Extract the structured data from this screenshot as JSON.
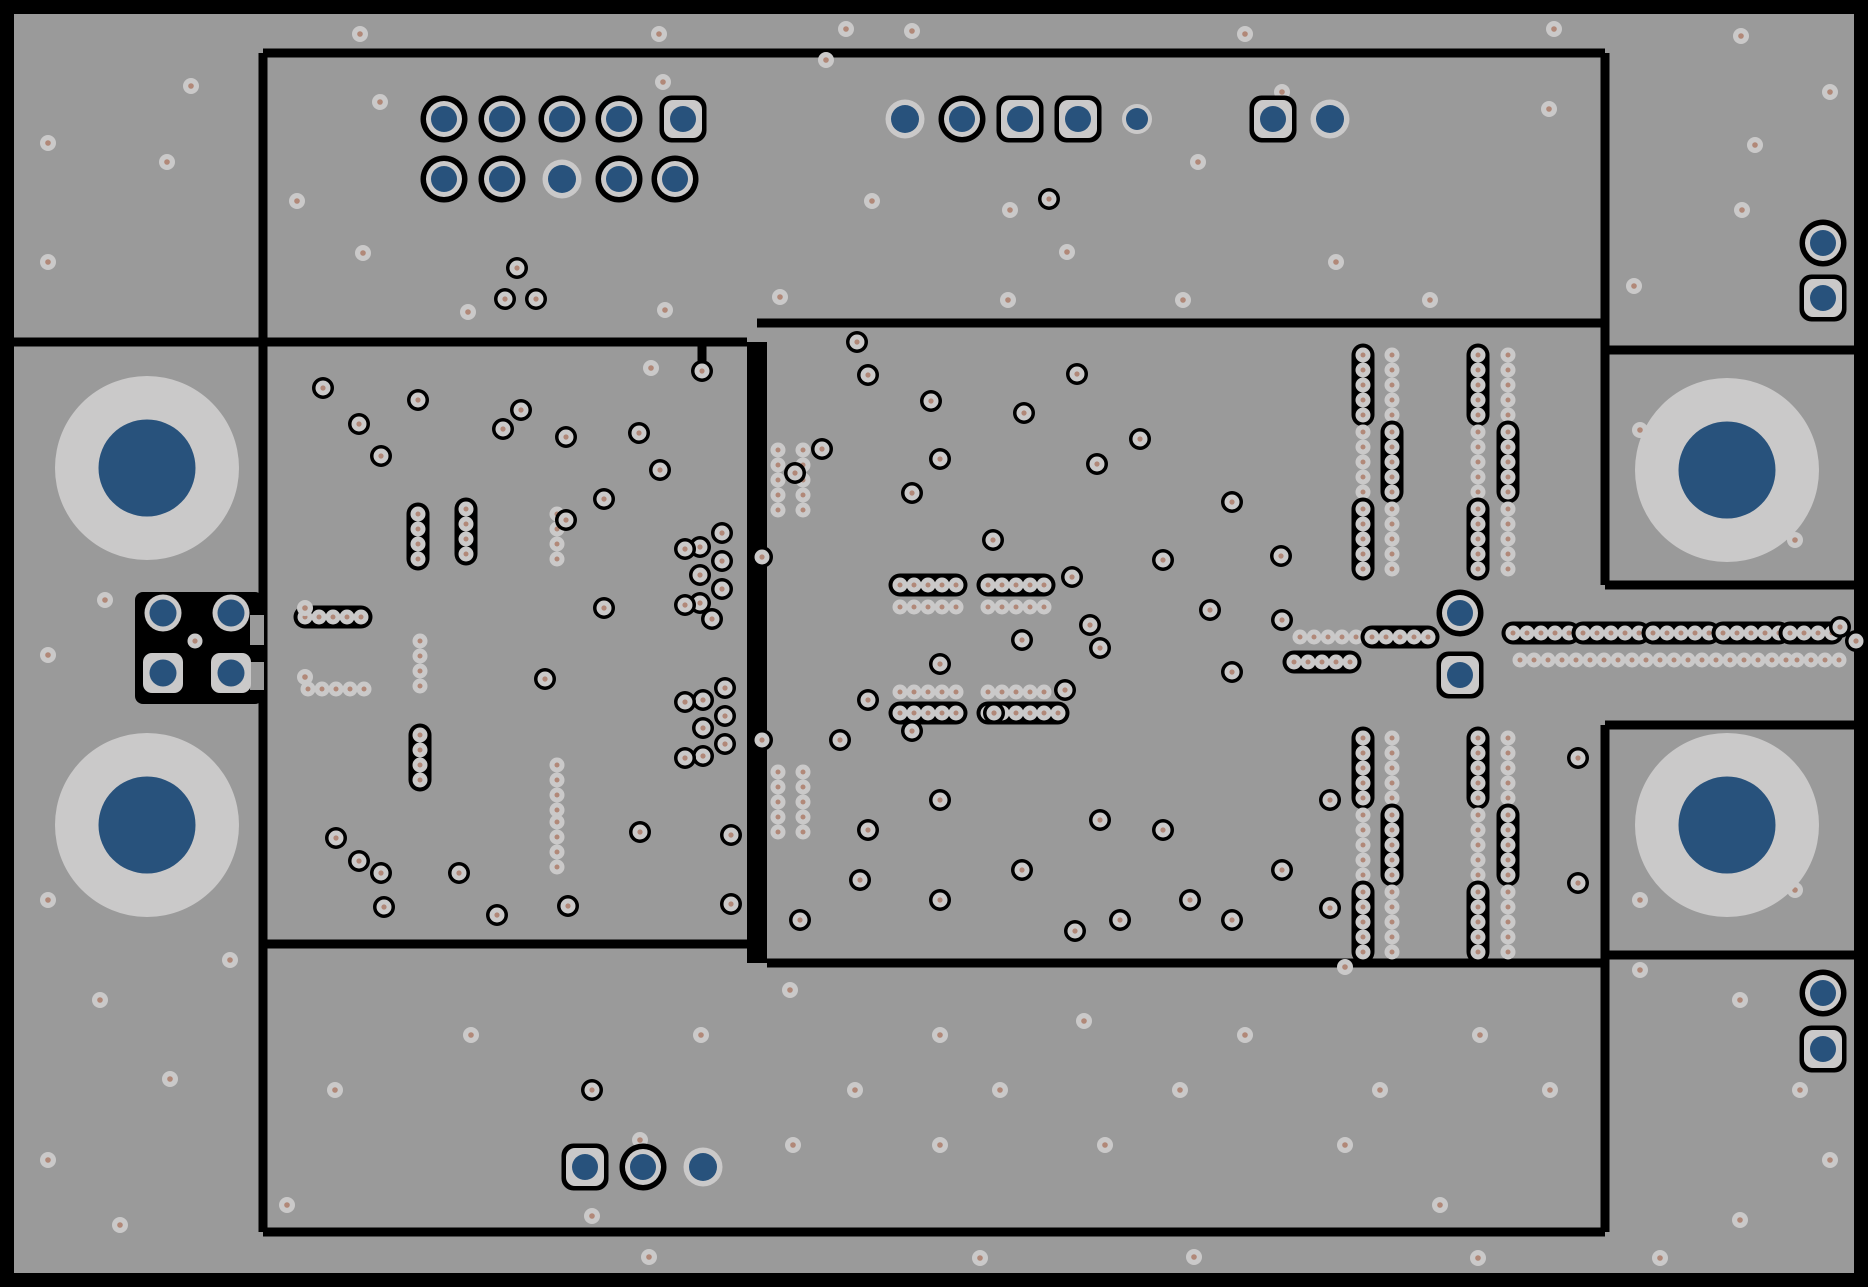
{
  "canvas": {
    "width": 1868,
    "height": 1287
  },
  "colors": {
    "background": "#000000",
    "copper": "#9a9a9a",
    "annular": "#cac9c9",
    "navy": "#28527c",
    "drill": "#b18878",
    "line": "#000000"
  },
  "board": {
    "frame": {
      "x": 14,
      "y": 14,
      "w": 1840,
      "h": 1259
    },
    "lines": [
      [
        263,
        53,
        1605,
        53
      ],
      [
        263,
        53,
        263,
        1232
      ],
      [
        1605,
        53,
        1605,
        585
      ],
      [
        14,
        342,
        747,
        342
      ],
      [
        757,
        323,
        1605,
        323
      ],
      [
        1605,
        350,
        1854,
        350
      ],
      [
        263,
        944,
        757,
        944
      ],
      [
        767,
        963,
        1605,
        963
      ],
      [
        1605,
        585,
        1854,
        585
      ],
      [
        1605,
        725,
        1854,
        725
      ],
      [
        1605,
        725,
        1605,
        1232
      ],
      [
        1605,
        955,
        1854,
        955
      ],
      [
        263,
        1232,
        1605,
        1232
      ],
      [
        702,
        342,
        702,
        364
      ]
    ],
    "divider": {
      "x": 747,
      "y": 342,
      "w": 20,
      "h": 621
    },
    "pad_cutout": {
      "x": 135,
      "y": 592,
      "w": 128,
      "h": 112,
      "r": 8,
      "notches": [
        [
          250,
          615,
          14,
          30
        ],
        [
          250,
          662,
          14,
          28
        ]
      ]
    }
  },
  "mount_holes": [
    [
      147,
      468
    ],
    [
      147,
      825
    ],
    [
      1727,
      470
    ],
    [
      1727,
      825
    ]
  ],
  "pads": {
    "ring": [
      [
        444,
        119
      ],
      [
        502,
        119
      ],
      [
        562,
        119
      ],
      [
        619,
        119
      ],
      [
        444,
        179
      ],
      [
        502,
        179
      ],
      [
        619,
        179
      ],
      [
        675,
        179
      ],
      [
        962,
        119
      ],
      [
        643,
        1167
      ],
      [
        1823,
        243
      ],
      [
        1823,
        993
      ],
      [
        1460,
        613
      ]
    ],
    "square": [
      [
        683,
        119
      ],
      [
        1020,
        119
      ],
      [
        1078,
        119
      ],
      [
        1273,
        119
      ],
      [
        585,
        1167
      ],
      [
        1823,
        298
      ],
      [
        1823,
        1049
      ],
      [
        1460,
        675
      ]
    ],
    "plain": [
      [
        562,
        179
      ],
      [
        905,
        119
      ],
      [
        1330,
        119
      ],
      [
        703,
        1167
      ]
    ],
    "plain_small": [
      [
        1137,
        119
      ]
    ],
    "patch_circle": [
      [
        163,
        613
      ],
      [
        231,
        613
      ]
    ],
    "patch_square": [
      [
        163,
        673
      ],
      [
        231,
        673
      ]
    ]
  },
  "ring_vias": [
    [
      323,
      388
    ],
    [
      359,
      424
    ],
    [
      381,
      456
    ],
    [
      418,
      400
    ],
    [
      503,
      429
    ],
    [
      521,
      410
    ],
    [
      566,
      437
    ],
    [
      639,
      433
    ],
    [
      702,
      371
    ],
    [
      604,
      499
    ],
    [
      566,
      520
    ],
    [
      660,
      470
    ],
    [
      604,
      608
    ],
    [
      545,
      679
    ],
    [
      762,
      557
    ],
    [
      336,
      838
    ],
    [
      359,
      861
    ],
    [
      381,
      873
    ],
    [
      459,
      873
    ],
    [
      497,
      915
    ],
    [
      384,
      907
    ],
    [
      640,
      832
    ],
    [
      731,
      835
    ],
    [
      568,
      906
    ],
    [
      731,
      904
    ],
    [
      700,
      547
    ],
    [
      722,
      533
    ],
    [
      700,
      575
    ],
    [
      722,
      561
    ],
    [
      700,
      603
    ],
    [
      722,
      589
    ],
    [
      685,
      549
    ],
    [
      685,
      605
    ],
    [
      712,
      619
    ],
    [
      703,
      700
    ],
    [
      725,
      688
    ],
    [
      703,
      728
    ],
    [
      725,
      716
    ],
    [
      703,
      756
    ],
    [
      725,
      744
    ],
    [
      685,
      702
    ],
    [
      685,
      758
    ],
    [
      868,
      375
    ],
    [
      931,
      401
    ],
    [
      940,
      459
    ],
    [
      912,
      493
    ],
    [
      993,
      540
    ],
    [
      1024,
      413
    ],
    [
      1077,
      374
    ],
    [
      1097,
      464
    ],
    [
      1140,
      439
    ],
    [
      1232,
      502
    ],
    [
      1281,
      556
    ],
    [
      1163,
      560
    ],
    [
      857,
      342
    ],
    [
      822,
      449
    ],
    [
      795,
      473
    ],
    [
      1210,
      610
    ],
    [
      1282,
      620
    ],
    [
      1232,
      672
    ],
    [
      1100,
      648
    ],
    [
      1065,
      690
    ],
    [
      1022,
      640
    ],
    [
      994,
      713
    ],
    [
      940,
      664
    ],
    [
      912,
      731
    ],
    [
      868,
      700
    ],
    [
      840,
      740
    ],
    [
      940,
      800
    ],
    [
      868,
      830
    ],
    [
      1022,
      870
    ],
    [
      1120,
      920
    ],
    [
      1232,
      920
    ],
    [
      1282,
      870
    ],
    [
      1330,
      908
    ],
    [
      1330,
      800
    ],
    [
      1163,
      830
    ],
    [
      1100,
      820
    ],
    [
      940,
      900
    ],
    [
      1190,
      900
    ],
    [
      1075,
      931
    ],
    [
      860,
      880
    ],
    [
      800,
      920
    ],
    [
      762,
      740
    ],
    [
      1578,
      758
    ],
    [
      1578,
      883
    ],
    [
      1840,
      627
    ],
    [
      1856,
      641
    ],
    [
      1072,
      577
    ],
    [
      1090,
      625
    ],
    [
      517,
      268
    ],
    [
      505,
      299
    ],
    [
      536,
      299
    ],
    [
      1049,
      199
    ],
    [
      592,
      1090
    ],
    [
      195,
      641
    ]
  ],
  "plain_vias": [
    [
      360,
      34
    ],
    [
      659,
      34
    ],
    [
      846,
      29
    ],
    [
      1245,
      34
    ],
    [
      1554,
      29
    ],
    [
      1741,
      36
    ],
    [
      912,
      31
    ],
    [
      191,
      86
    ],
    [
      48,
      143
    ],
    [
      167,
      162
    ],
    [
      380,
      102
    ],
    [
      297,
      201
    ],
    [
      663,
      82
    ],
    [
      826,
      60
    ],
    [
      872,
      201
    ],
    [
      1010,
      210
    ],
    [
      1198,
      162
    ],
    [
      1282,
      92
    ],
    [
      1549,
      109
    ],
    [
      1742,
      210
    ],
    [
      48,
      262
    ],
    [
      363,
      253
    ],
    [
      468,
      312
    ],
    [
      665,
      310
    ],
    [
      780,
      297
    ],
    [
      1008,
      300
    ],
    [
      1067,
      252
    ],
    [
      1183,
      300
    ],
    [
      1336,
      262
    ],
    [
      1755,
      145
    ],
    [
      1430,
      300
    ],
    [
      1634,
      286
    ],
    [
      1830,
      92
    ],
    [
      651,
      368
    ],
    [
      48,
      655
    ],
    [
      105,
      600
    ],
    [
      48,
      900
    ],
    [
      100,
      1000
    ],
    [
      170,
      1079
    ],
    [
      48,
      1160
    ],
    [
      230,
      960
    ],
    [
      305,
      608
    ],
    [
      305,
      677
    ],
    [
      335,
      1090
    ],
    [
      471,
      1035
    ],
    [
      640,
      1140
    ],
    [
      701,
      1035
    ],
    [
      790,
      990
    ],
    [
      855,
      1090
    ],
    [
      940,
      1035
    ],
    [
      1000,
      1090
    ],
    [
      1084,
      1021
    ],
    [
      1180,
      1090
    ],
    [
      1245,
      1035
    ],
    [
      1380,
      1090
    ],
    [
      1480,
      1035
    ],
    [
      1550,
      1090
    ],
    [
      793,
      1145
    ],
    [
      940,
      1145
    ],
    [
      1105,
      1145
    ],
    [
      1345,
      1145
    ],
    [
      1440,
      1205
    ],
    [
      287,
      1205
    ],
    [
      649,
      1257
    ],
    [
      980,
      1258
    ],
    [
      1194,
      1257
    ],
    [
      1478,
      1258
    ],
    [
      120,
      1225
    ],
    [
      1345,
      967
    ],
    [
      592,
      1216
    ],
    [
      1640,
      430
    ],
    [
      1795,
      540
    ],
    [
      1640,
      900
    ],
    [
      1795,
      890
    ],
    [
      1740,
      1000
    ],
    [
      1800,
      1090
    ],
    [
      1830,
      1160
    ],
    [
      1640,
      970
    ],
    [
      1740,
      1220
    ],
    [
      1660,
      1258
    ]
  ],
  "chains": [
    {
      "x": 900,
      "y": 585,
      "n": 5,
      "dir": "h",
      "o": 1
    },
    {
      "x": 988,
      "y": 585,
      "n": 5,
      "dir": "h",
      "o": 1
    },
    {
      "x": 900,
      "y": 713,
      "n": 5,
      "dir": "h",
      "o": 1
    },
    {
      "x": 988,
      "y": 713,
      "n": 6,
      "dir": "h",
      "o": 1
    },
    {
      "x": 900,
      "y": 607,
      "n": 5,
      "dir": "h",
      "o": 0
    },
    {
      "x": 988,
      "y": 607,
      "n": 5,
      "dir": "h",
      "o": 0
    },
    {
      "x": 900,
      "y": 692,
      "n": 5,
      "dir": "h",
      "o": 0
    },
    {
      "x": 988,
      "y": 692,
      "n": 5,
      "dir": "h",
      "o": 0
    },
    {
      "x": 1300,
      "y": 637,
      "n": 5,
      "dir": "h",
      "o": 0
    },
    {
      "x": 1294,
      "y": 662,
      "n": 5,
      "dir": "h",
      "o": 1
    },
    {
      "x": 1372,
      "y": 637,
      "n": 5,
      "dir": "h",
      "o": 1
    },
    {
      "x": 1513,
      "y": 633,
      "n": 5,
      "dir": "h",
      "o": 1
    },
    {
      "x": 1583,
      "y": 633,
      "n": 5,
      "dir": "h",
      "o": 1
    },
    {
      "x": 1653,
      "y": 633,
      "n": 5,
      "dir": "h",
      "o": 1
    },
    {
      "x": 1723,
      "y": 633,
      "n": 5,
      "dir": "h",
      "o": 1
    },
    {
      "x": 1790,
      "y": 633,
      "n": 4,
      "dir": "h",
      "o": 1
    },
    {
      "x": 1520,
      "y": 660,
      "n": 5,
      "dir": "h",
      "o": 0
    },
    {
      "x": 1590,
      "y": 660,
      "n": 5,
      "dir": "h",
      "o": 0
    },
    {
      "x": 1660,
      "y": 660,
      "n": 5,
      "dir": "h",
      "o": 0
    },
    {
      "x": 1730,
      "y": 660,
      "n": 5,
      "dir": "h",
      "o": 0
    },
    {
      "x": 1797,
      "y": 660,
      "n": 4,
      "dir": "h",
      "o": 0
    },
    {
      "x": 418,
      "y": 514,
      "n": 4,
      "dir": "v",
      "o": 1
    },
    {
      "x": 466,
      "y": 509,
      "n": 4,
      "dir": "v",
      "o": 1
    },
    {
      "x": 557,
      "y": 514,
      "n": 4,
      "dir": "v",
      "o": 0
    },
    {
      "x": 305,
      "y": 617,
      "n": 5,
      "dir": "h",
      "o": 1
    },
    {
      "x": 308,
      "y": 689,
      "n": 5,
      "dir": "h",
      "o": 0
    },
    {
      "x": 420,
      "y": 641,
      "n": 4,
      "dir": "v",
      "o": 0
    },
    {
      "x": 420,
      "y": 735,
      "n": 4,
      "dir": "v",
      "o": 1
    },
    {
      "x": 557,
      "y": 765,
      "n": 4,
      "dir": "v",
      "o": 0
    },
    {
      "x": 557,
      "y": 822,
      "n": 4,
      "dir": "v",
      "o": 0
    },
    {
      "x": 778,
      "y": 450,
      "n": 5,
      "dir": "v",
      "o": 0
    },
    {
      "x": 803,
      "y": 450,
      "n": 5,
      "dir": "v",
      "o": 0
    },
    {
      "x": 778,
      "y": 772,
      "n": 5,
      "dir": "v",
      "o": 0
    },
    {
      "x": 803,
      "y": 772,
      "n": 5,
      "dir": "v",
      "o": 0
    },
    {
      "x": 1363,
      "y": 355,
      "n": 5,
      "dir": "v",
      "o": 1
    },
    {
      "x": 1392,
      "y": 355,
      "n": 5,
      "dir": "v",
      "o": 0
    },
    {
      "x": 1478,
      "y": 355,
      "n": 5,
      "dir": "v",
      "o": 1
    },
    {
      "x": 1508,
      "y": 355,
      "n": 5,
      "dir": "v",
      "o": 0
    },
    {
      "x": 1363,
      "y": 432,
      "n": 5,
      "dir": "v",
      "o": 0
    },
    {
      "x": 1392,
      "y": 432,
      "n": 5,
      "dir": "v",
      "o": 1
    },
    {
      "x": 1478,
      "y": 432,
      "n": 5,
      "dir": "v",
      "o": 0
    },
    {
      "x": 1508,
      "y": 432,
      "n": 5,
      "dir": "v",
      "o": 1
    },
    {
      "x": 1363,
      "y": 509,
      "n": 5,
      "dir": "v",
      "o": 1
    },
    {
      "x": 1392,
      "y": 509,
      "n": 5,
      "dir": "v",
      "o": 0
    },
    {
      "x": 1478,
      "y": 509,
      "n": 5,
      "dir": "v",
      "o": 1
    },
    {
      "x": 1508,
      "y": 509,
      "n": 5,
      "dir": "v",
      "o": 0
    },
    {
      "x": 1363,
      "y": 738,
      "n": 5,
      "dir": "v",
      "o": 1
    },
    {
      "x": 1392,
      "y": 738,
      "n": 5,
      "dir": "v",
      "o": 0
    },
    {
      "x": 1478,
      "y": 738,
      "n": 5,
      "dir": "v",
      "o": 1
    },
    {
      "x": 1508,
      "y": 738,
      "n": 5,
      "dir": "v",
      "o": 0
    },
    {
      "x": 1363,
      "y": 815,
      "n": 5,
      "dir": "v",
      "o": 0
    },
    {
      "x": 1392,
      "y": 815,
      "n": 5,
      "dir": "v",
      "o": 1
    },
    {
      "x": 1478,
      "y": 815,
      "n": 5,
      "dir": "v",
      "o": 0
    },
    {
      "x": 1508,
      "y": 815,
      "n": 5,
      "dir": "v",
      "o": 1
    },
    {
      "x": 1363,
      "y": 892,
      "n": 5,
      "dir": "v",
      "o": 1
    },
    {
      "x": 1392,
      "y": 892,
      "n": 5,
      "dir": "v",
      "o": 0
    },
    {
      "x": 1478,
      "y": 892,
      "n": 5,
      "dir": "v",
      "o": 1
    },
    {
      "x": 1508,
      "y": 892,
      "n": 5,
      "dir": "v",
      "o": 0
    }
  ]
}
